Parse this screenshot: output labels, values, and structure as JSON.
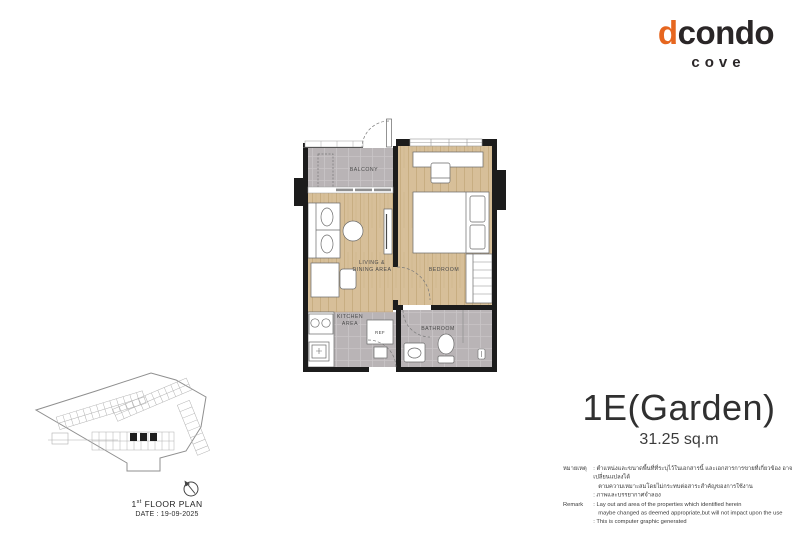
{
  "logo": {
    "brand_d": "d",
    "brand_rest": "condo",
    "subtitle": "cove",
    "accent_color": "#e6661f",
    "dark_color": "#2a2627"
  },
  "unit": {
    "name": "1E(Garden)",
    "area": "31.25 sq.m"
  },
  "plan": {
    "labels": {
      "balcony": "BALCONY",
      "living_line1": "LIVING &",
      "living_line2": "DINING AREA",
      "bedroom": "BEDROOM",
      "kitchen_line1": "KITCHEN",
      "kitchen_line2": "AREA",
      "ref": "REF",
      "bathroom": "BATHROOM"
    },
    "colors": {
      "wall": "#1c1c1c",
      "wood_floor": "#d7bf99",
      "tile_floor": "#b9b4b6"
    }
  },
  "site_plan": {
    "floor_number": "1",
    "floor_ordinal": "st",
    "title": "FLOOR PLAN",
    "date": "DATE : 19-09-2025"
  },
  "remarks": {
    "rows": [
      {
        "label": "หมายเหตุ",
        "text": ": ตำแหน่งและขนาดพื้นที่ที่ระบุไว้ในเอกสารนี้ และเอกสารการขายที่เกี่ยวข้อง อาจเปลี่ยนแปลงได้"
      },
      {
        "label": "",
        "text": "ตามความเหมาะสมโดยไม่กระทบต่อสาระสำคัญของการใช้งาน"
      },
      {
        "label": "",
        "text": ": ภาพและบรรยากาศจำลอง"
      },
      {
        "label": "Remark",
        "text": ": Lay out and area of the properties which identified herein"
      },
      {
        "label": "",
        "text": "maybe changed as deemed appropriate,but will not impact upon the use"
      },
      {
        "label": "",
        "text": ": This is computer graphic generated"
      }
    ]
  }
}
